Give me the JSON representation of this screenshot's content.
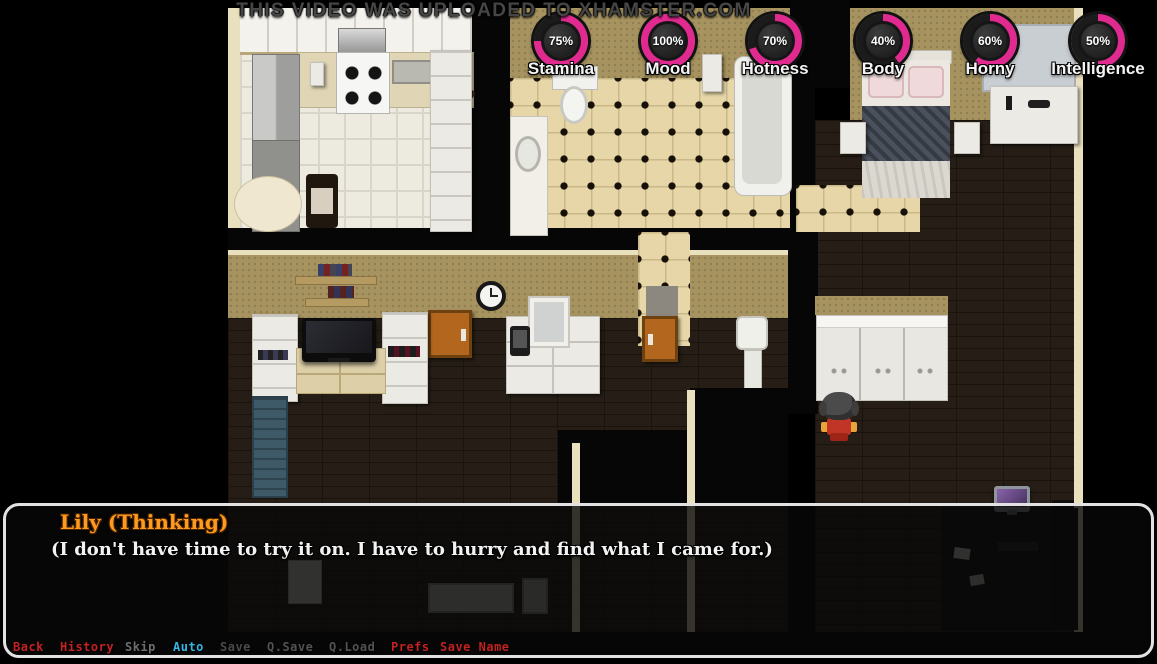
{
  "watermark": "THIS VIDEO WAS UPLOADED TO XHAMSTER.COM",
  "stats": {
    "accent": "#e02a8f",
    "items": [
      {
        "label": "Stamina",
        "percent": 75,
        "display": "75%"
      },
      {
        "label": "Mood",
        "percent": 100,
        "display": "100%"
      },
      {
        "label": "Hotness",
        "percent": 70,
        "display": "70%"
      },
      {
        "label": "Body",
        "percent": 40,
        "display": "40%"
      },
      {
        "label": "Horny",
        "percent": 60,
        "display": "60%"
      },
      {
        "label": "Intelligence",
        "percent": 50,
        "display": "50%"
      }
    ]
  },
  "dialogue": {
    "speaker": "Lily (Thinking)",
    "speaker_color": "#ff9a1f",
    "text": "(I don't have time to try it on. I have to hurry and find what I came for.)"
  },
  "quick_menu": {
    "items": [
      {
        "label": "Back",
        "color": "#c32222"
      },
      {
        "label": "History",
        "color": "#c32222"
      },
      {
        "label": "Skip",
        "color": "#6e6e6e"
      },
      {
        "label": "Auto",
        "color": "#35b5e5"
      },
      {
        "label": "Save",
        "color": "#4a4a4a"
      },
      {
        "label": "Q.Save",
        "color": "#525252"
      },
      {
        "label": "Q.Load",
        "color": "#525252"
      },
      {
        "label": "Prefs",
        "color": "#c32222"
      },
      {
        "label": "Save Name",
        "color": "#c32222"
      }
    ]
  }
}
